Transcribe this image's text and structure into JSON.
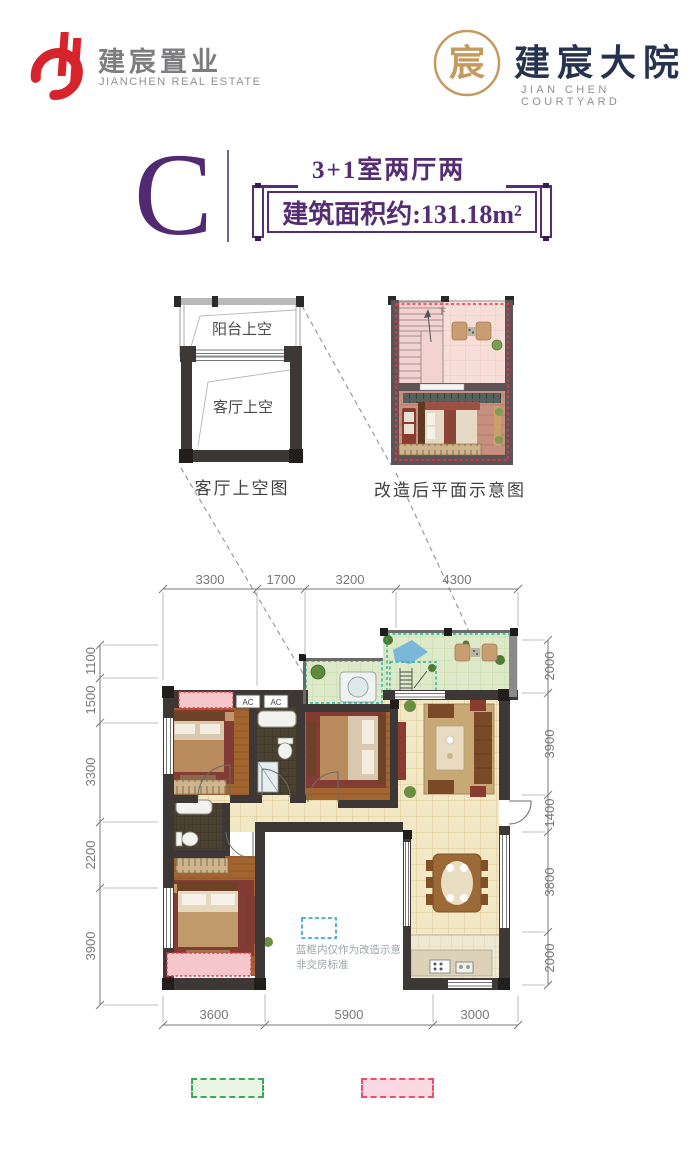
{
  "header": {
    "brand_cn": "建宸置业",
    "brand_en": "JIANCHEN REAL ESTATE",
    "project_cn": "建宸大院",
    "project_en": "JIAN CHEN COURTYARD",
    "seal_glyph": "宸"
  },
  "unit": {
    "letter": "C",
    "layout": "3+1室两厅两卫",
    "area": "建筑面积约:131.18m²"
  },
  "diagrams": {
    "left": {
      "balcony_label": "阳台上空",
      "living_label": "客厅上空",
      "caption": "客厅上空图"
    },
    "right": {
      "caption": "改造后平面示意图",
      "stair_down": "下"
    }
  },
  "plan": {
    "ac_label": "AC",
    "note_line1": "蓝框内仅作为改造示意",
    "note_line2": "非交房标准",
    "dims": {
      "top": [
        "3300",
        "1700",
        "3200",
        "4300"
      ],
      "left": [
        "1100",
        "1500",
        "3300",
        "2200",
        "3900"
      ],
      "right": [
        "2000",
        "3900",
        "1400",
        "3800",
        "2000"
      ],
      "bottom": [
        "3600",
        "5900",
        "3000"
      ]
    }
  },
  "colors": {
    "brand_red": "#d7232b",
    "brand_gold": "#c59a5f",
    "brand_navy": "#27324f",
    "accent_purple": "#512a72",
    "terrace_dash": "#1fb4a4",
    "reno_dash": "#e8374a",
    "note_dash": "#3fa9e0",
    "legend_green": "#3da75c",
    "legend_pink": "#e85070"
  }
}
